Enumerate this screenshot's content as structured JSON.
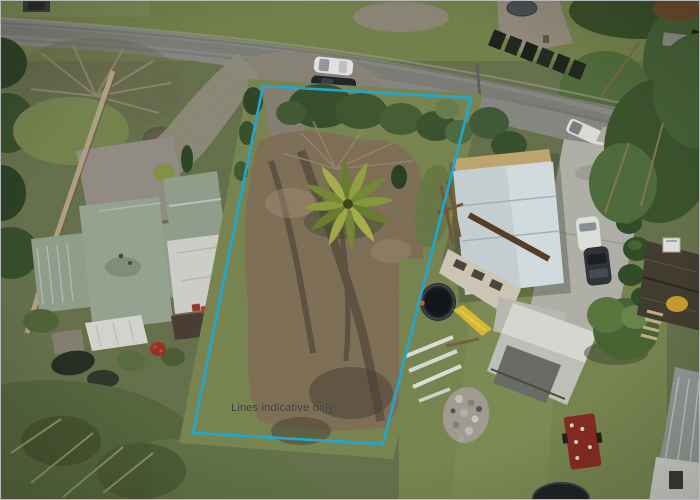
{
  "image": {
    "kind": "aerial-drone-photo",
    "subject": "vacant residential section between two houses, road at top",
    "width_px": 700,
    "height_px": 500
  },
  "overlay": {
    "boundary_label": "Lines indicative only",
    "boundary_points": "262,85 470,97 382,443 192,432",
    "boundary_color": "#1fa7d4",
    "label_color": "#3c3c3c"
  },
  "palette": {
    "boundary": "#1fa7d4",
    "label": "#3c3c3c",
    "road": "#8d8d89",
    "dirt": "#85755c",
    "mud": "#564b3c",
    "roofGreen": "#97a693",
    "roofWhite": "#d7d8d1",
    "roofBlue": "#cfdadd",
    "concrete": "#b9b8b0",
    "grassLight": "#7e8c55",
    "grassDark": "#5a6b40",
    "treeDark": "#3b5330",
    "wallTan": "#b9a988",
    "slideYellow": "#e3c235",
    "trailerRed": "#8d2e24"
  },
  "scene": {
    "objects": [
      "road",
      "white-car",
      "dark-car",
      "white-ute",
      "vacant-lot-dirt",
      "palm-tree",
      "hedge-row",
      "left-house-green-roof",
      "garden-wall",
      "left-garden",
      "right-house-blue-roof",
      "concrete-driveway",
      "trampoline",
      "yellow-slide",
      "white-poles",
      "rubble-pile",
      "shed",
      "red-trailer",
      "cabin",
      "second-trampoline"
    ]
  }
}
